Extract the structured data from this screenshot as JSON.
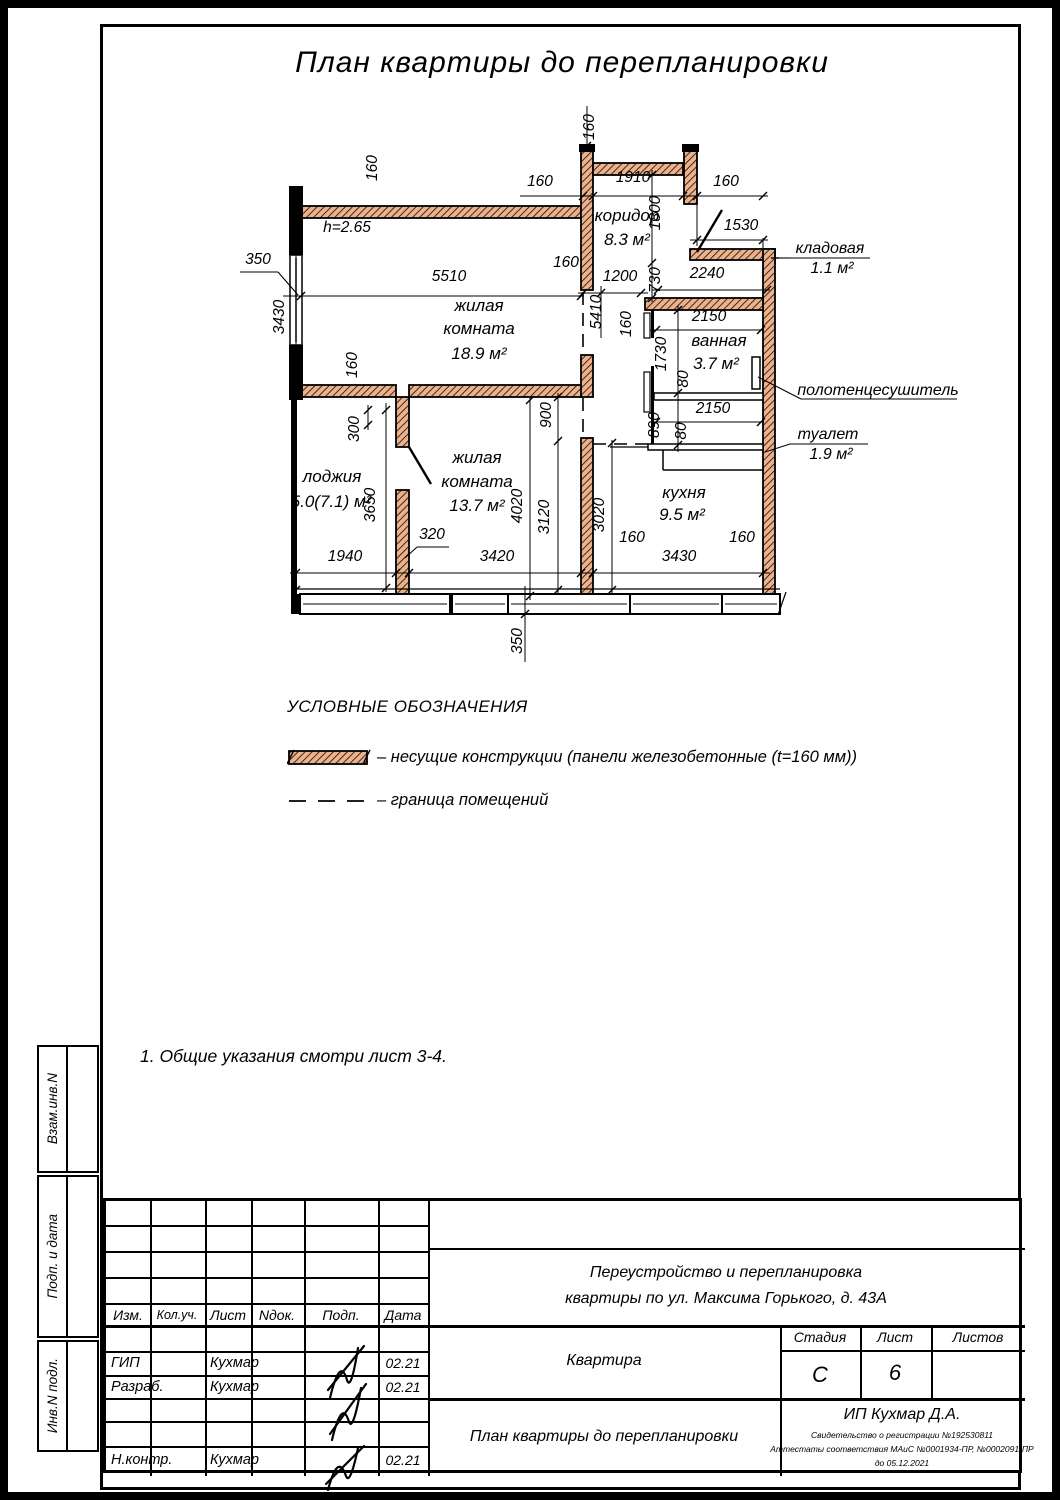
{
  "sheet": {
    "title": "План квартиры до перепланировки"
  },
  "plan": {
    "labels": [
      {
        "t": "160",
        "x": 594,
        "y": 127,
        "r": -90
      },
      {
        "t": "160",
        "x": 540,
        "y": 186
      },
      {
        "t": "1910",
        "x": 633,
        "y": 182
      },
      {
        "t": "160",
        "x": 726,
        "y": 186
      },
      {
        "t": "1530",
        "x": 741,
        "y": 230
      },
      {
        "t": "1800",
        "x": 660,
        "y": 213,
        "r": -90
      },
      {
        "t": "730",
        "x": 660,
        "y": 280,
        "r": -90
      },
      {
        "t": "2240",
        "x": 707,
        "y": 278
      },
      {
        "t": "1200",
        "x": 620,
        "y": 281
      },
      {
        "t": "160",
        "x": 566,
        "y": 267
      },
      {
        "t": "5410",
        "x": 601,
        "y": 312,
        "r": -90
      },
      {
        "t": "160",
        "x": 631,
        "y": 324,
        "r": -90
      },
      {
        "t": "2150",
        "x": 709,
        "y": 321
      },
      {
        "t": "1730",
        "x": 666,
        "y": 354,
        "r": -90
      },
      {
        "t": "80",
        "x": 688,
        "y": 379,
        "r": -90
      },
      {
        "t": "890",
        "x": 659,
        "y": 425,
        "r": -90
      },
      {
        "t": "80",
        "x": 686,
        "y": 431,
        "r": -90
      },
      {
        "t": "2150",
        "x": 713,
        "y": 413
      },
      {
        "t": "350",
        "x": 258,
        "y": 264
      },
      {
        "t": "5510",
        "x": 449,
        "y": 281
      },
      {
        "t": "3430",
        "x": 284,
        "y": 317,
        "r": -90
      },
      {
        "t": "160",
        "x": 377,
        "y": 168,
        "r": -90
      },
      {
        "t": "160",
        "x": 357,
        "y": 365,
        "r": -90
      },
      {
        "t": "300",
        "x": 359,
        "y": 429,
        "r": -90
      },
      {
        "t": "3650",
        "x": 375,
        "y": 505,
        "r": -90
      },
      {
        "t": "900",
        "x": 551,
        "y": 415,
        "r": -90
      },
      {
        "t": "4020",
        "x": 522,
        "y": 506,
        "r": -90
      },
      {
        "t": "3120",
        "x": 549,
        "y": 517,
        "r": -90
      },
      {
        "t": "3020",
        "x": 604,
        "y": 515,
        "r": -90
      },
      {
        "t": "1940",
        "x": 345,
        "y": 561
      },
      {
        "t": "320",
        "x": 432,
        "y": 539
      },
      {
        "t": "3420",
        "x": 497,
        "y": 561
      },
      {
        "t": "160",
        "x": 632,
        "y": 542
      },
      {
        "t": "160",
        "x": 742,
        "y": 542
      },
      {
        "t": "3430",
        "x": 679,
        "y": 561
      },
      {
        "t": "350",
        "x": 522,
        "y": 641,
        "r": -90
      },
      {
        "t": "h=2.65",
        "x": 347,
        "y": 232
      },
      {
        "t": "жилая",
        "x": 479,
        "y": 311,
        "c": "room"
      },
      {
        "t": "комната",
        "x": 479,
        "y": 334,
        "c": "room"
      },
      {
        "t": "18.9 м²",
        "x": 479,
        "y": 359,
        "c": "room"
      },
      {
        "t": "коридор",
        "x": 627,
        "y": 221,
        "c": "room"
      },
      {
        "t": "8.3 м²",
        "x": 627,
        "y": 245,
        "c": "room"
      },
      {
        "t": "ванная",
        "x": 719,
        "y": 346,
        "c": "room"
      },
      {
        "t": "3.7 м²",
        "x": 716,
        "y": 369,
        "c": "room"
      },
      {
        "t": "кухня",
        "x": 684,
        "y": 498,
        "c": "room"
      },
      {
        "t": "9.5 м²",
        "x": 682,
        "y": 520,
        "c": "room"
      },
      {
        "t": "лоджия",
        "x": 332,
        "y": 482,
        "c": "room"
      },
      {
        "t": "5.0(7.1) м²",
        "x": 331,
        "y": 507,
        "c": "room"
      },
      {
        "t": "жилая",
        "x": 477,
        "y": 463,
        "c": "room"
      },
      {
        "t": "комната",
        "x": 477,
        "y": 487,
        "c": "room"
      },
      {
        "t": "13.7 м²",
        "x": 477,
        "y": 511,
        "c": "room"
      },
      {
        "t": "кладовая",
        "x": 830,
        "y": 253,
        "c": "call"
      },
      {
        "t": "1.1 м²",
        "x": 832,
        "y": 273,
        "c": "call"
      },
      {
        "t": "полотенцесушитель",
        "x": 878,
        "y": 395,
        "c": "call"
      },
      {
        "t": "туалет",
        "x": 828,
        "y": 439,
        "c": "call"
      },
      {
        "t": "1.9 м²",
        "x": 831,
        "y": 459,
        "c": "call"
      }
    ]
  },
  "legend": {
    "title": "УСЛОВНЫЕ ОБОЗНАЧЕНИЯ",
    "items": [
      "–  несущие конструкции (панели железобетонные  (t=160 мм))",
      "–  граница помещений"
    ]
  },
  "notes": {
    "line1": "1. Общие указания смотри лист 3-4."
  },
  "side_stamps": {
    "a": "Взам.инв.N",
    "b": "Подп. и дата",
    "c": "Инв.N подл."
  },
  "title_block": {
    "cols": {
      "izm": "Изм.",
      "kol": "Кол.уч.",
      "list": "Лист",
      "ndok": "Nдок.",
      "podp": "Подп.",
      "data": "Дата"
    },
    "rows": [
      {
        "role": "ГИП",
        "name": "Кухмар",
        "date": "02.21"
      },
      {
        "role": "Разраб.",
        "name": "Кухмар",
        "date": "02.21"
      },
      {
        "role": "Н.контр.",
        "name": "Кухмар",
        "date": "02.21"
      }
    ],
    "project_line1": "Переустройство и перепланировка",
    "project_line2": "квартиры по ул. Максима Горького, д. 43А",
    "object": "Квартира",
    "doc_title": "План квартиры до перепланировки",
    "stage_label": "Стадия",
    "sheet_label": "Лист",
    "sheets_label": "Листов",
    "stage": "С",
    "sheet_num": "6",
    "firm": "ИП Кухмар Д.А.",
    "cert1": "Свидетельство о регистрации №192530811",
    "cert2": "Аттестаты соответствия МАиС №0001934-ПР, №0002091-ПР",
    "cert3": "до 05.12.2021"
  }
}
